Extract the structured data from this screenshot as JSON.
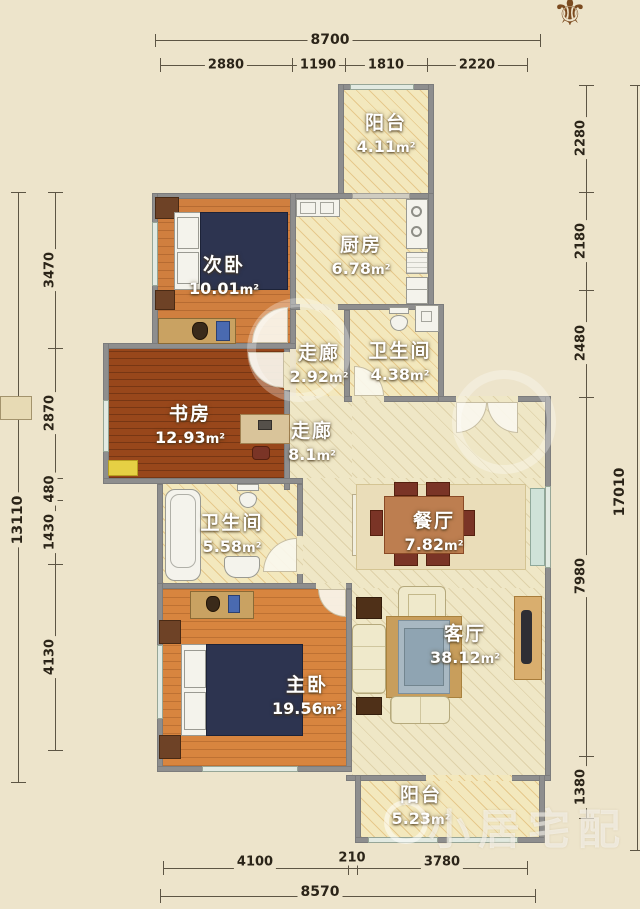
{
  "title": "apartment-floor-plan",
  "compass": {
    "glyph": "⚜"
  },
  "watermark": {
    "text": "小居宅配"
  },
  "rooms": [
    {
      "id": "balcony-top",
      "name": "阳台",
      "area": "4.11",
      "unit": "m²"
    },
    {
      "id": "kitchen",
      "name": "厨房",
      "area": "6.78",
      "unit": "m²"
    },
    {
      "id": "bedroom-2",
      "name": "次卧",
      "area": "10.01",
      "unit": "m²"
    },
    {
      "id": "corridor-1",
      "name": "走廊",
      "area": "2.92",
      "unit": "m²"
    },
    {
      "id": "bathroom-1",
      "name": "卫生间",
      "area": "4.38",
      "unit": "m²"
    },
    {
      "id": "study",
      "name": "书房",
      "area": "12.93",
      "unit": "m²"
    },
    {
      "id": "corridor-2",
      "name": "走廊",
      "area": "8.1",
      "unit": "m²"
    },
    {
      "id": "dining",
      "name": "餐厅",
      "area": "7.82",
      "unit": "m²"
    },
    {
      "id": "bathroom-2",
      "name": "卫生间",
      "area": "5.58",
      "unit": "m²"
    },
    {
      "id": "master-bedroom",
      "name": "主卧",
      "area": "19.56",
      "unit": "m²"
    },
    {
      "id": "living",
      "name": "客厅",
      "area": "38.12",
      "unit": "m²"
    },
    {
      "id": "balcony-bottom",
      "name": "阳台",
      "area": "5.23",
      "unit": "m²"
    }
  ],
  "dimensions": {
    "top_total": "8700",
    "top_segments": [
      "2880",
      "1190",
      "1810",
      "2220"
    ],
    "bottom_segments": [
      "4100",
      "210",
      "3780"
    ],
    "bottom_total": "8570",
    "left_segments": [
      "3470",
      "2870",
      "480",
      "1430",
      "4130"
    ],
    "left_total": "13110",
    "right_segments": [
      "2280",
      "2180",
      "2480",
      "7980",
      "1380"
    ],
    "right_total": "17010"
  },
  "colors": {
    "background": "#ede4cb",
    "wall": "#8e8e8e",
    "wood_orange": "#d07f3f",
    "wood_dark": "#98471b",
    "hatch_cream": "#f3e8bd",
    "bed_navy": "#2d3450",
    "dim_text": "#2b2418",
    "label_text": "#ffffff"
  }
}
